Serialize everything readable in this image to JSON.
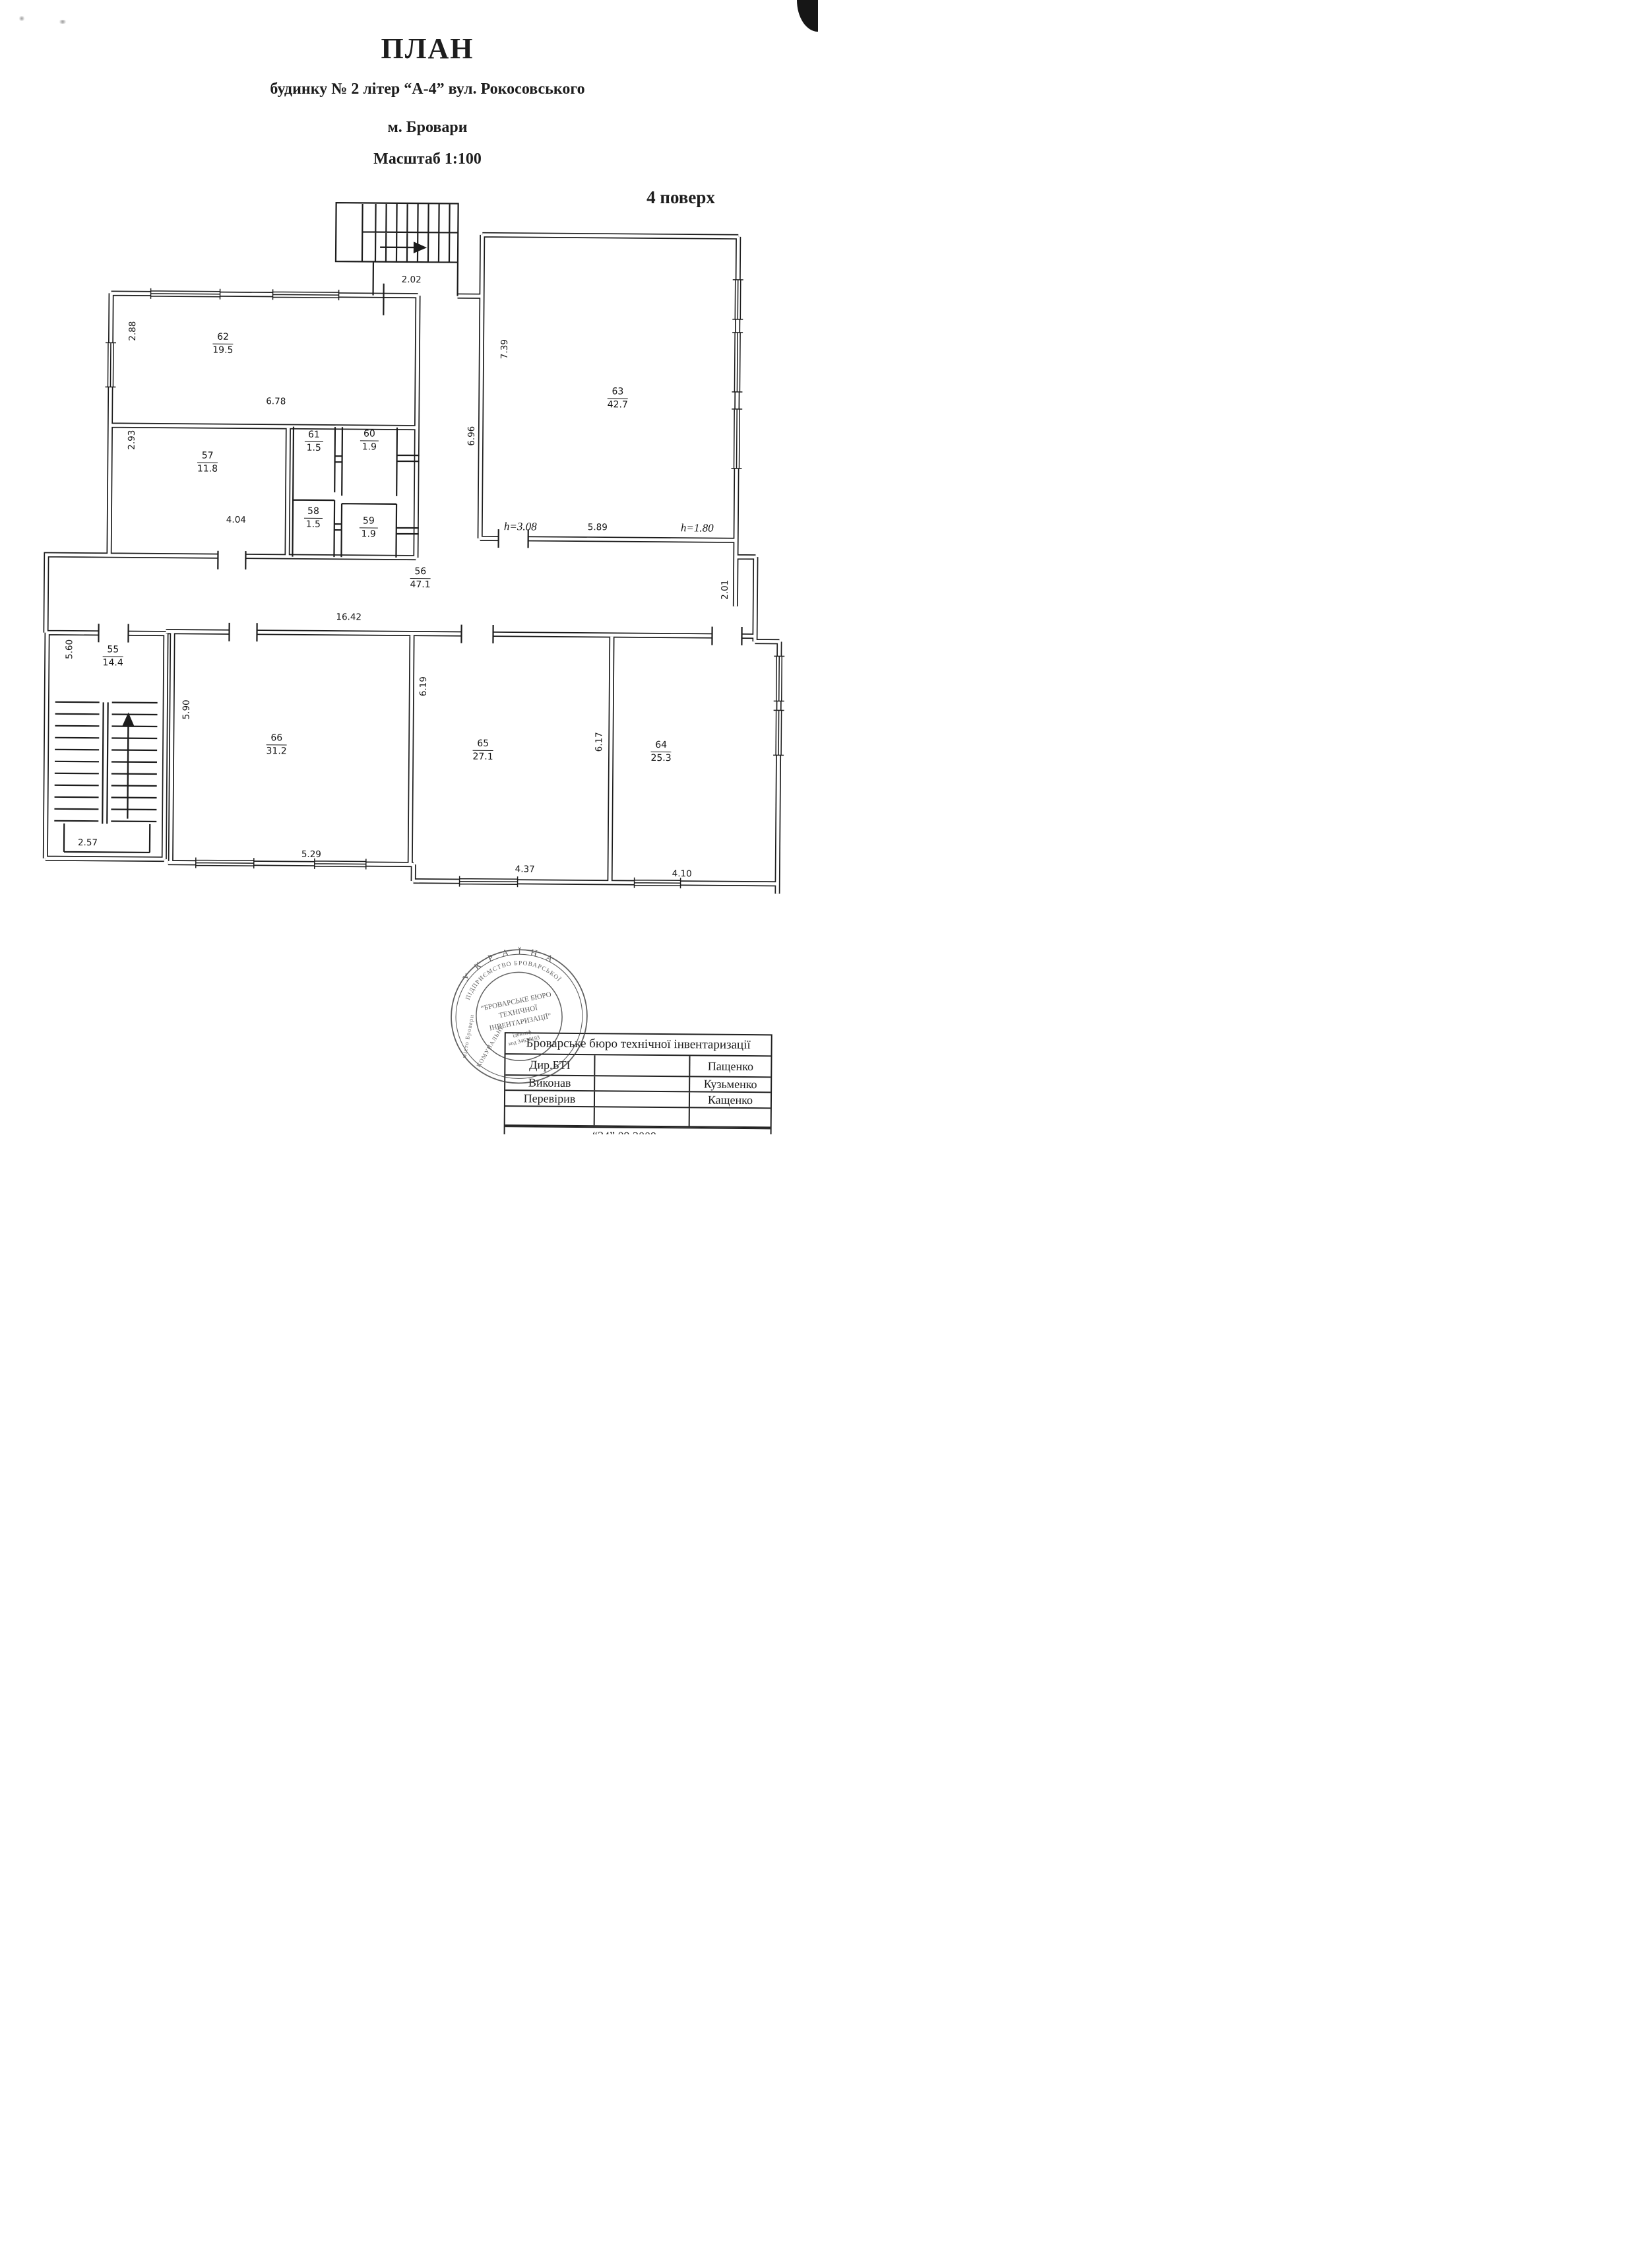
{
  "header": {
    "title": "ПЛАН",
    "subtitle": "будинку № 2 літер “А-4” вул. Рокосовського",
    "city": "м. Бровари",
    "scale_label": "Масштаб  1:100",
    "floor_label": "4 поверх"
  },
  "rooms": {
    "r55": {
      "num": "55",
      "area": "14.4"
    },
    "r56": {
      "num": "56",
      "area": "47.1"
    },
    "r57": {
      "num": "57",
      "area": "11.8"
    },
    "r58": {
      "num": "58",
      "area": "1.5"
    },
    "r59": {
      "num": "59",
      "area": "1.9"
    },
    "r60": {
      "num": "60",
      "area": "1.9"
    },
    "r61": {
      "num": "61",
      "area": "1.5"
    },
    "r62": {
      "num": "62",
      "area": "19.5"
    },
    "r63": {
      "num": "63",
      "area": "42.7"
    },
    "r64": {
      "num": "64",
      "area": "25.3"
    },
    "r65": {
      "num": "65",
      "area": "27.1"
    },
    "r66": {
      "num": "66",
      "area": "31.2"
    }
  },
  "dims": {
    "vestibule_width": "2.02",
    "r62_left": "2.88",
    "r62_width": "6.78",
    "r57_left": "2.93",
    "r57_width": "4.04",
    "r63_left_height": "7.39",
    "corridor63_height": "6.96",
    "r63_width": "5.89",
    "r63_h_left": "h=3.08",
    "r63_h_right": "h=1.80",
    "corridor_width": "16.42",
    "corridor_right": "2.01",
    "r55_left": "5.60",
    "r55_width": "2.57",
    "r66_left": "5.90",
    "r66_width": "5.29",
    "r65_left": "6.19",
    "r65_width": "4.37",
    "r64_left": "6.17",
    "r64_width": "4.10"
  },
  "stamp": {
    "country": "У К Р А Ї Н А",
    "ring_line": "ПІДПРИЄМСТВО  БРОВАРСЬКОЇ",
    "ring_left_upper": "КОМУНАЛЬНЕ",
    "ring_left_lower": "місто Бровари",
    "org_line1": "“БРОВАРСЬКЕ БЮРО",
    "org_line2": "ТЕХНІЧНОЇ",
    "org_line3": "ІНВЕНТАРИЗАЦІЇ”",
    "id_line1": "ідентиф.",
    "id_line2": "код 34636193"
  },
  "footer_table": {
    "header": "Броварське  бюро технічної інвентаризації",
    "rows": [
      {
        "label": "Дир.БТІ",
        "name": "Пащенко"
      },
      {
        "label": "Виконав",
        "name": "Кузьменко"
      },
      {
        "label": "Перевірив",
        "name": "Кащенко"
      }
    ],
    "date": "“24” 09  2009 року"
  }
}
